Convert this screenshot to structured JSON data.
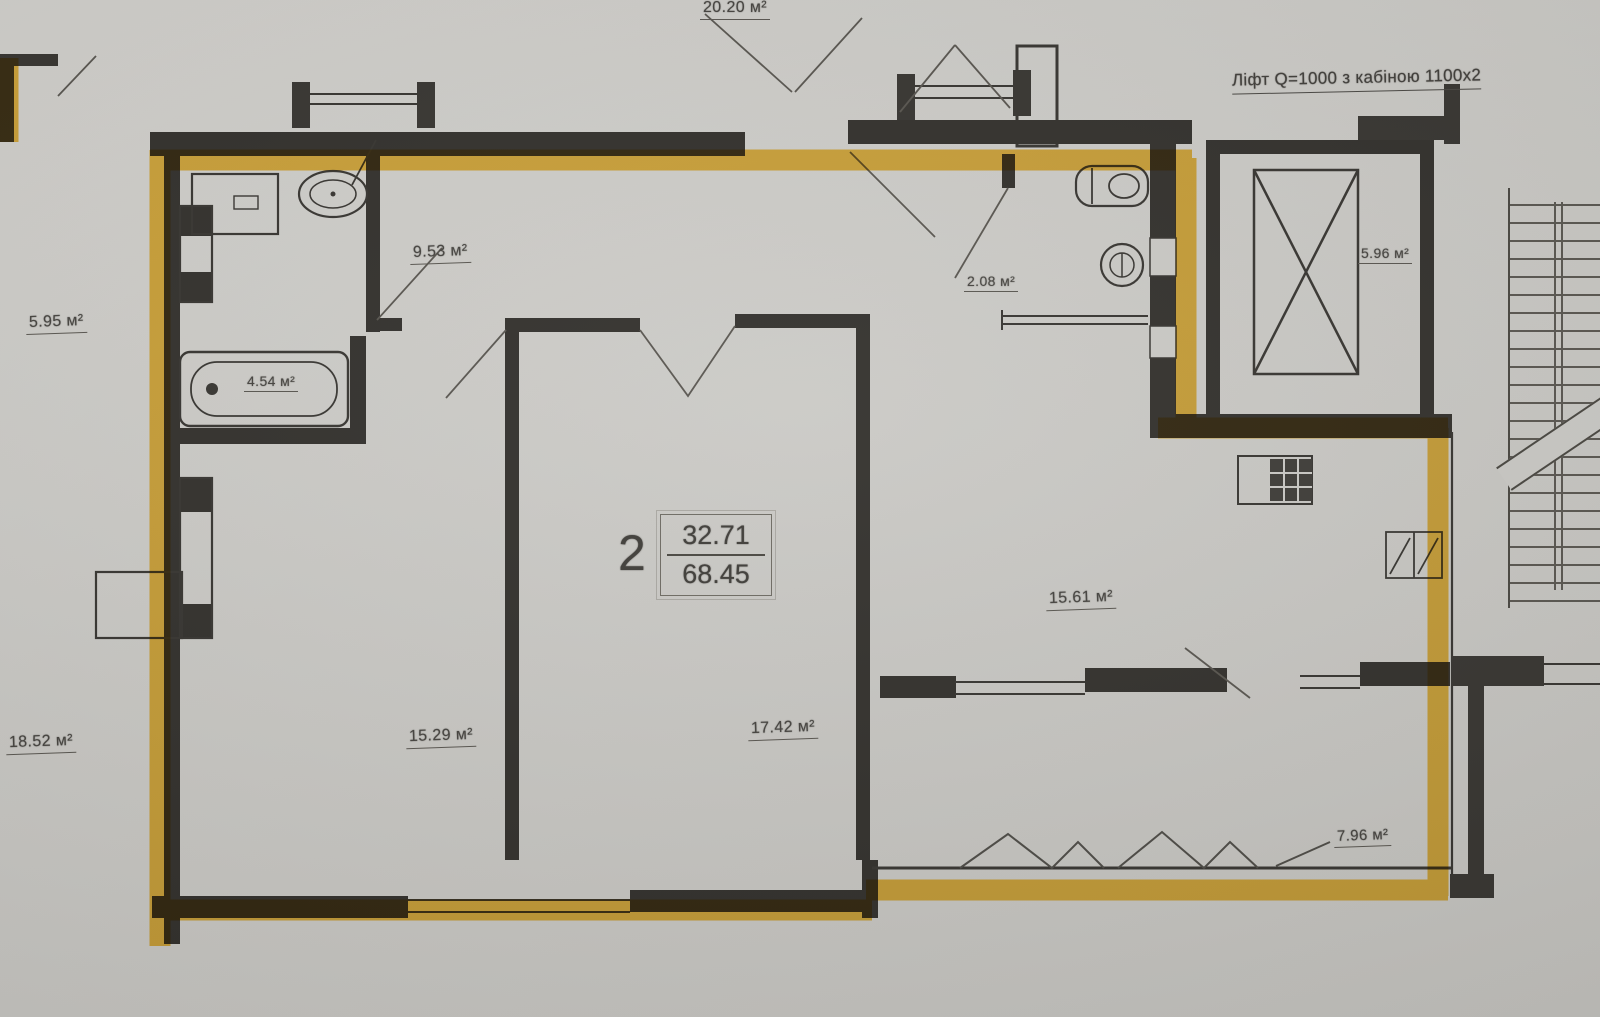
{
  "document": {
    "type": "apartment floor plan (scanned)",
    "apartment_label": "2"
  },
  "colors": {
    "highlight": "#F6B512",
    "paper": "#C9C8C4",
    "ink": "#3A3834"
  },
  "apartment": {
    "number": "2",
    "upper_value": "32.71",
    "lower_value": "68.45"
  },
  "notes": {
    "elevator": "Ліфт Q=1000 з кабіною 1100х2"
  },
  "labels": {
    "hall": "9.53 м²",
    "bathroom": "4.54 м²",
    "wc": "2.08 м²",
    "bedroom": "15.29 м²",
    "living": "17.42 м²",
    "kitchen": "15.61 м²",
    "balcony": "7.96 м²",
    "elevator_shaft": "5.96 м²",
    "neighbor_top": "20.20 м²",
    "neighbor_left_upper": "5.95 м²",
    "neighbor_left_lower": "18.52 м²"
  }
}
